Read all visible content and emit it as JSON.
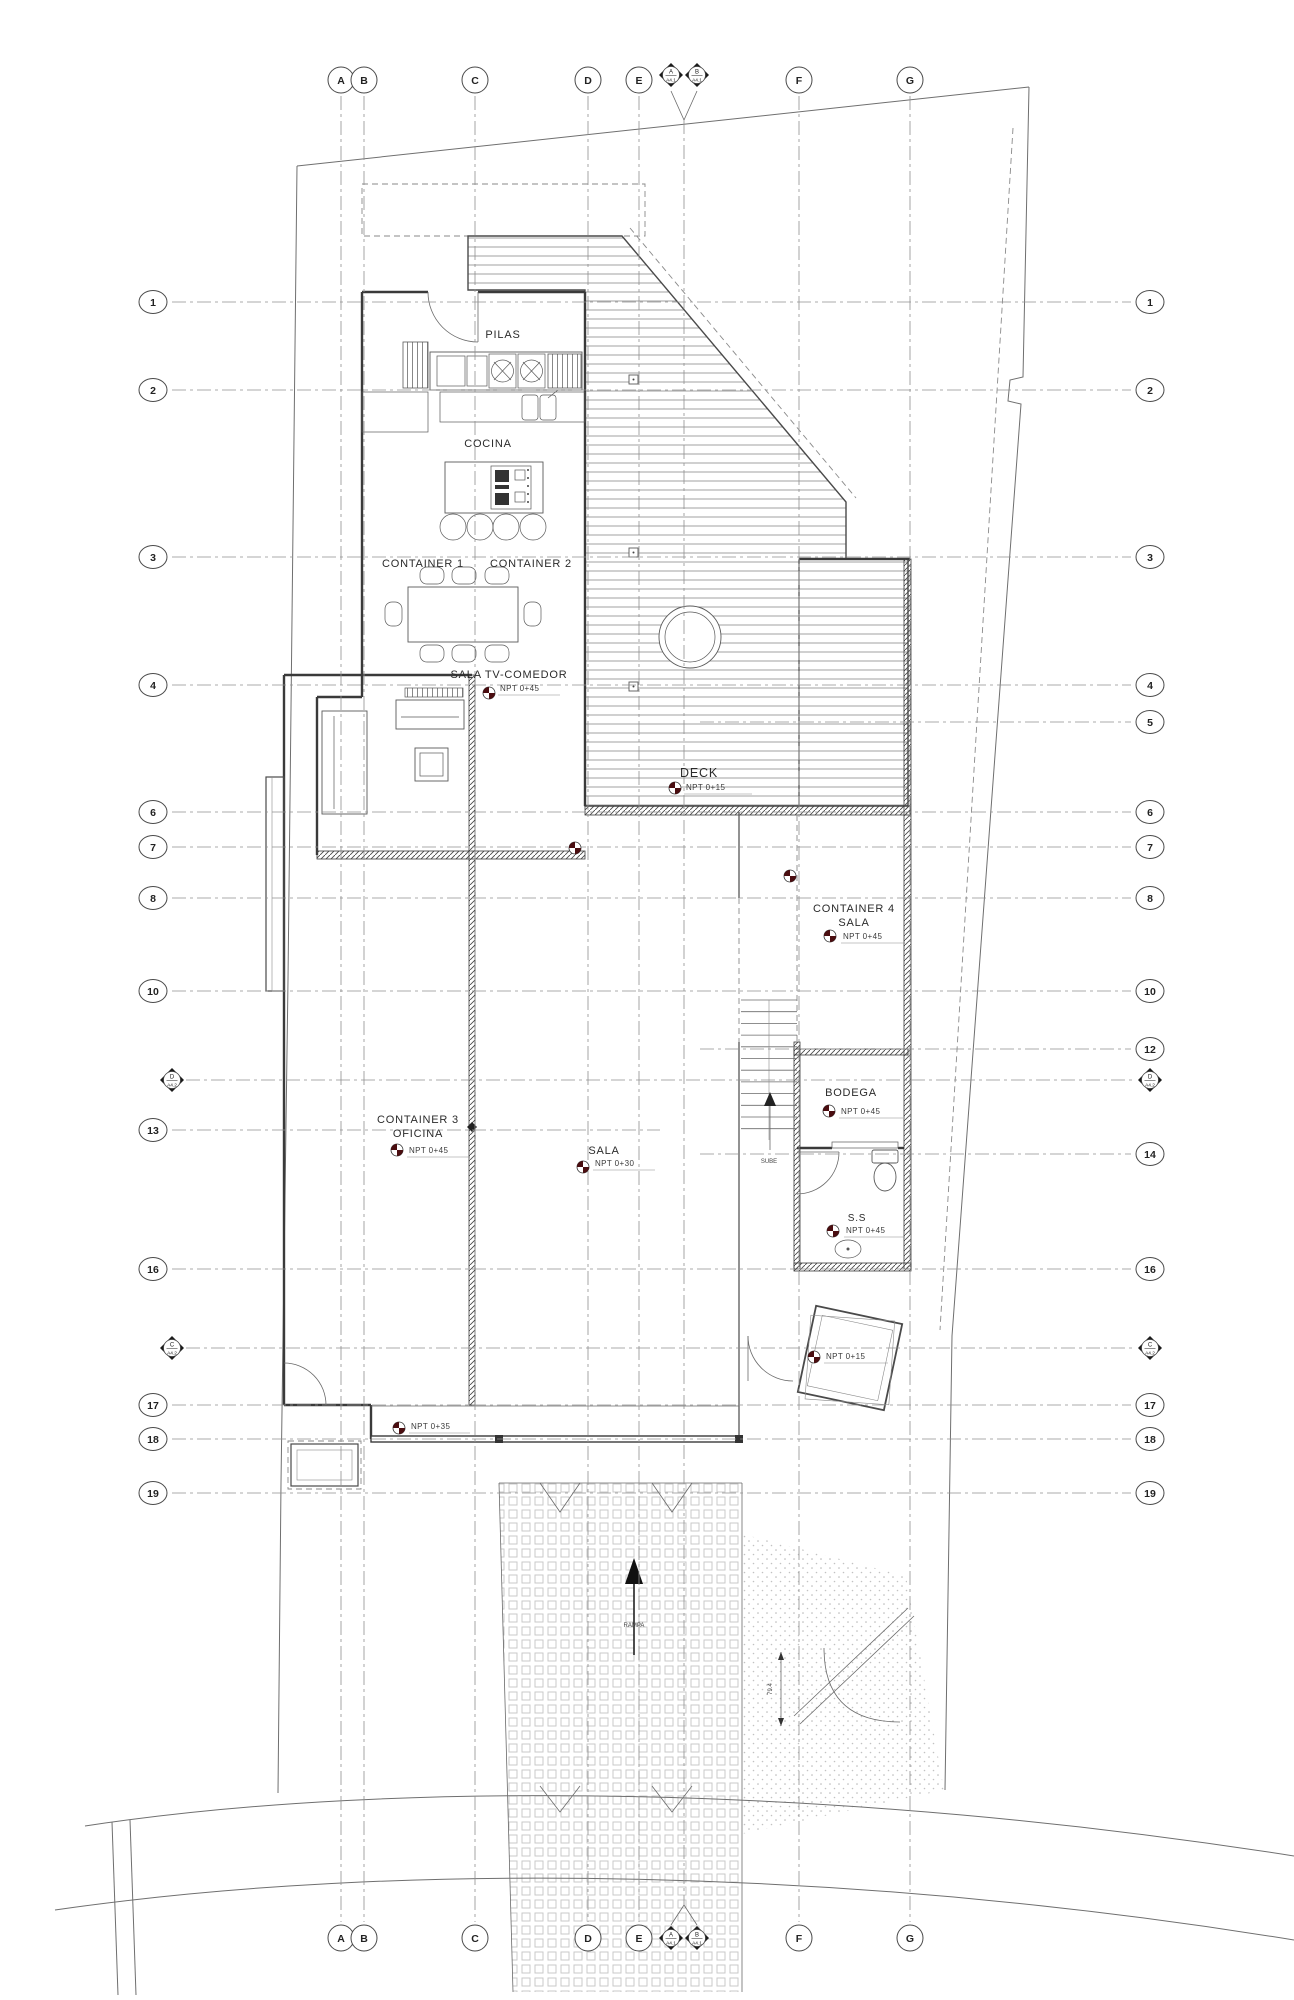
{
  "drawing": {
    "type": "architectural floor plan",
    "colors": {
      "background": "#ffffff",
      "lines": "#4a4a4a",
      "grid": "#909090",
      "npt_marker": "#4a0d10",
      "hatch": "#8a8a8a"
    }
  },
  "grid": {
    "letters": [
      {
        "label": "A",
        "x": 341
      },
      {
        "label": "B",
        "x": 364
      },
      {
        "label": "C",
        "x": 475
      },
      {
        "label": "D",
        "x": 588
      },
      {
        "label": "E",
        "x": 639
      },
      {
        "label": "F",
        "x": 799
      },
      {
        "label": "G",
        "x": 910
      }
    ],
    "rows": [
      {
        "label": "1",
        "y": 302,
        "sides": "both"
      },
      {
        "label": "2",
        "y": 390,
        "sides": "both"
      },
      {
        "label": "3",
        "y": 557,
        "sides": "both"
      },
      {
        "label": "4",
        "y": 685,
        "sides": "both"
      },
      {
        "label": "5",
        "y": 722,
        "sides": "right"
      },
      {
        "label": "6",
        "y": 812,
        "sides": "both"
      },
      {
        "label": "7",
        "y": 847,
        "sides": "both"
      },
      {
        "label": "8",
        "y": 898,
        "sides": "both"
      },
      {
        "label": "10",
        "y": 991,
        "sides": "both"
      },
      {
        "label": "12",
        "y": 1049,
        "sides": "right"
      },
      {
        "label": "13",
        "y": 1130,
        "sides": "left"
      },
      {
        "label": "14",
        "y": 1154,
        "sides": "right"
      },
      {
        "label": "16",
        "y": 1269,
        "sides": "both"
      },
      {
        "label": "17",
        "y": 1405,
        "sides": "both"
      },
      {
        "label": "18",
        "y": 1439,
        "sides": "both"
      },
      {
        "label": "19",
        "y": 1493,
        "sides": "both"
      }
    ]
  },
  "sections": {
    "vertical": [
      {
        "label": "A",
        "sheet": "A4.1",
        "x": 671
      },
      {
        "label": "B",
        "sheet": "A4.1",
        "x": 697
      }
    ],
    "horizontal": [
      {
        "label": "D",
        "sheet": "A4.2",
        "y": 1080
      },
      {
        "label": "C",
        "sheet": "A4.2",
        "y": 1348
      }
    ]
  },
  "rooms": {
    "pilas": {
      "label": "PILAS"
    },
    "cocina": {
      "label": "COCINA"
    },
    "container1": {
      "label": "CONTAINER 1"
    },
    "container2": {
      "label": "CONTAINER 2"
    },
    "sala_tv": {
      "label": "SALA TV-COMEDOR",
      "npt": "NPT  0+45"
    },
    "deck": {
      "label": "DECK",
      "npt": "NPT  0+15"
    },
    "container4": {
      "label": "CONTAINER 4",
      "sub": "SALA",
      "npt": "NPT  0+45"
    },
    "bodega": {
      "label": "BODEGA",
      "npt": "NPT  0+45"
    },
    "ss": {
      "label": "S.S",
      "npt": "NPT  0+45"
    },
    "container3": {
      "label": "CONTAINER 3",
      "sub": "OFICINA",
      "npt": "NPT  0+45"
    },
    "sala": {
      "label": "SALA",
      "npt": "NPT  0+30"
    },
    "entry": {
      "npt": "NPT  0+15"
    },
    "vestibule": {
      "npt": "NPT  0+35"
    }
  },
  "annotations": {
    "sube": "SUBE",
    "rampa": "RAMPA",
    "dimension": "79.4"
  }
}
